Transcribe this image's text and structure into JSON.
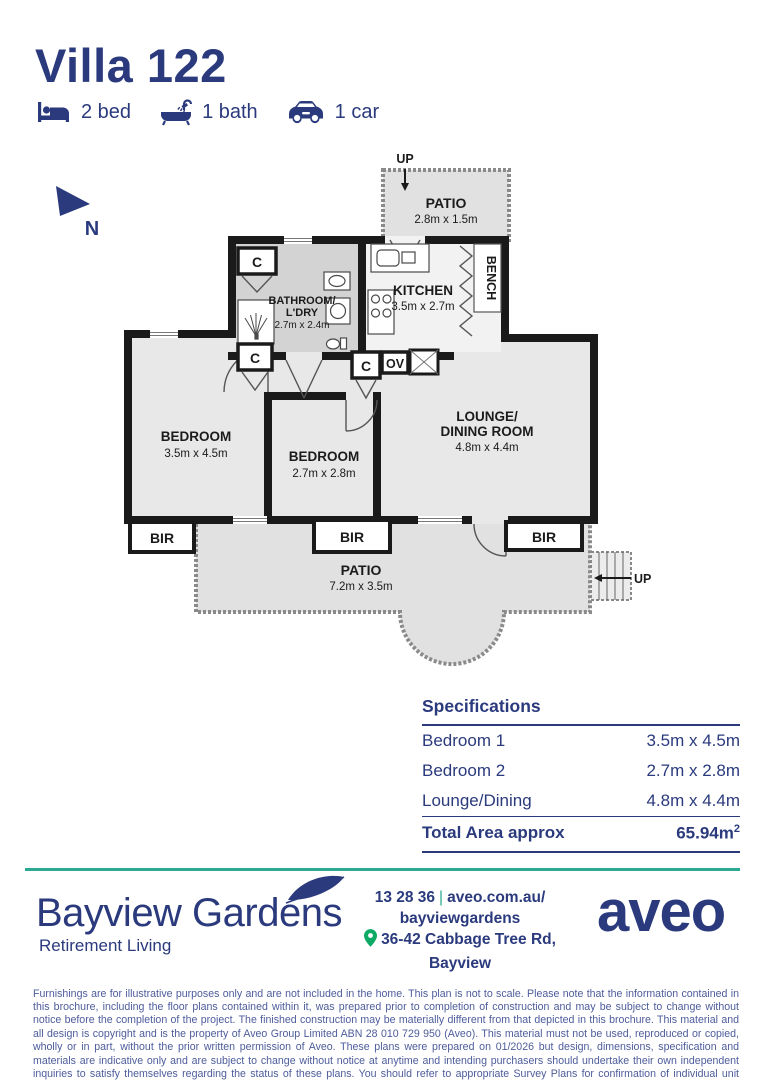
{
  "header": {
    "title": "Villa 122",
    "features": [
      {
        "icon": "bed-icon",
        "label": "2 bed"
      },
      {
        "icon": "bath-icon",
        "label": "1 bath"
      },
      {
        "icon": "car-icon",
        "label": "1 car"
      }
    ]
  },
  "compass": {
    "label": "N"
  },
  "floorplan": {
    "rooms": {
      "patio_top": {
        "name": "PATIO",
        "dims": "2.8m x 1.5m"
      },
      "kitchen": {
        "name": "KITCHEN",
        "dims": "3.5m x 2.7m"
      },
      "bathroom": {
        "name_line1": "BATHROOM/",
        "name_line2": "L'DRY",
        "dims": "2.7m x 2.4m"
      },
      "bedroom1": {
        "name": "BEDROOM",
        "dims": "3.5m x 4.5m"
      },
      "bedroom2": {
        "name": "BEDROOM",
        "dims": "2.7m x 2.8m"
      },
      "lounge": {
        "name_line1": "LOUNGE/",
        "name_line2": "DINING ROOM",
        "dims": "4.8m x 4.4m"
      },
      "patio_bottom": {
        "name": "PATIO",
        "dims": "7.2m x 3.5m"
      }
    },
    "labels": {
      "up": "UP",
      "bench": "BENCH",
      "oven": "OV",
      "cupboard": "C",
      "robe": "BIR"
    }
  },
  "specs": {
    "heading": "Specifications",
    "rows": [
      [
        "Bedroom 1",
        "3.5m x 4.5m"
      ],
      [
        "Bedroom 2",
        "2.7m x 2.8m"
      ],
      [
        "Lounge/Dining",
        "4.8m x 4.4m"
      ]
    ],
    "total_label": "Total Area approx",
    "total_value": "65.94m",
    "total_sup": "2"
  },
  "footer": {
    "brand": "Bayview Gardens",
    "tagline": "Retirement Living",
    "phone": "13 28 36",
    "separator": "|",
    "website_line1": "aveo.com.au/",
    "website_line2": "bayviewgardens",
    "address": "36-42 Cabbage Tree Rd, Bayview",
    "logo": "aveo"
  },
  "disclaimer": "Furnishings are for illustrative purposes only and are not included in the home. This plan is not to scale. Please note that the information contained in this brochure, including the floor plans contained within it, was prepared prior to completion of construction and may be subject to change without notice before the completion of the project. The finished construction may be materially different from that depicted in this brochure. This material and all design is copyright and is the property of Aveo Group Limited ABN 28 010 729 950 (Aveo). This material must not be used, reproduced or copied, wholly or in part, without the prior written permission of Aveo. These plans were prepared on 01/2026 but design, dimensions, specification and materials are indicative only and are subject to change without notice at anytime and intending purchasers should undertake their own independent inquiries to satisfy themselves regarding the status of these plans. You should refer to appropriate Survey Plans for confirmation of individual unit areas.",
  "colors": {
    "navy": "#2a3a7d",
    "teal": "#2da892",
    "green": "#0caa64"
  }
}
